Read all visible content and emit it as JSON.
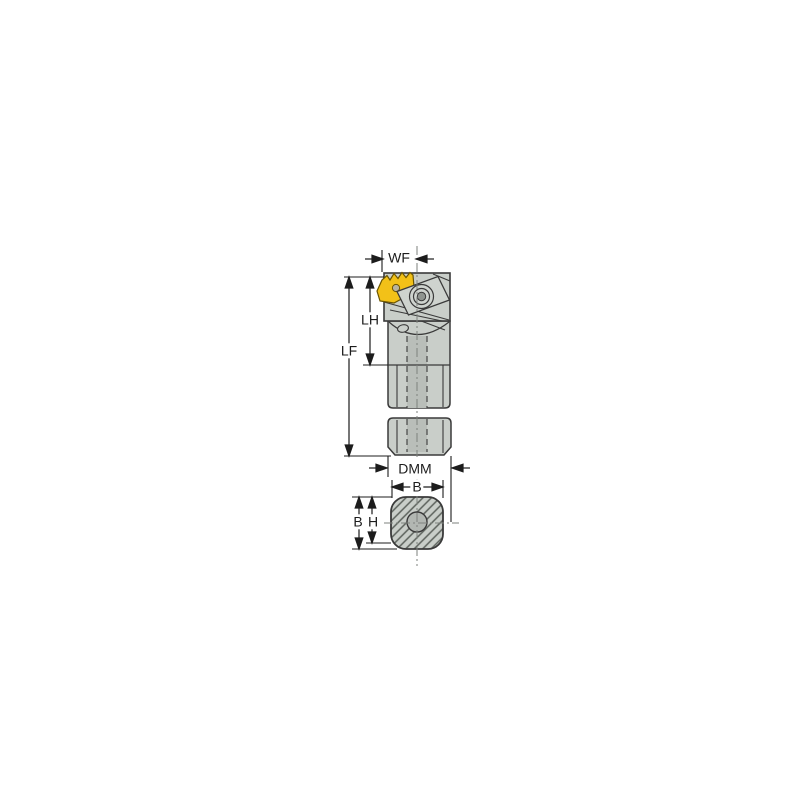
{
  "colors": {
    "background": "#ffffff",
    "body": "#c9cec9",
    "clamp": "#ced3ce",
    "channel": "#b9beb9",
    "hole": "#b2b7b2",
    "outline": "#3a3a3a",
    "dim": "#1c1c1c",
    "centerline": "#7d827d",
    "insert": "#f2c118",
    "insert_edge": "#6b5500",
    "hatch": "#5c625c"
  },
  "diagram": {
    "description": "Dimension drawing of a threading tool holder: side view with indexable insert and clamp, broken round shank, and shank cross-section view below",
    "dimensions": [
      {
        "id": "wf",
        "label": "WF",
        "orientation": "horizontal",
        "view": "side"
      },
      {
        "id": "lh",
        "label": "LH",
        "orientation": "vertical",
        "view": "side"
      },
      {
        "id": "lf",
        "label": "LF",
        "orientation": "vertical",
        "view": "side"
      },
      {
        "id": "dmm",
        "label": "DMM",
        "orientation": "horizontal",
        "view": "side"
      },
      {
        "id": "b_top",
        "label": "B",
        "orientation": "horizontal",
        "view": "cross-section"
      },
      {
        "id": "b_side",
        "label": "B",
        "orientation": "vertical",
        "view": "cross-section"
      },
      {
        "id": "h_side",
        "label": "H",
        "orientation": "vertical",
        "view": "cross-section"
      }
    ]
  }
}
